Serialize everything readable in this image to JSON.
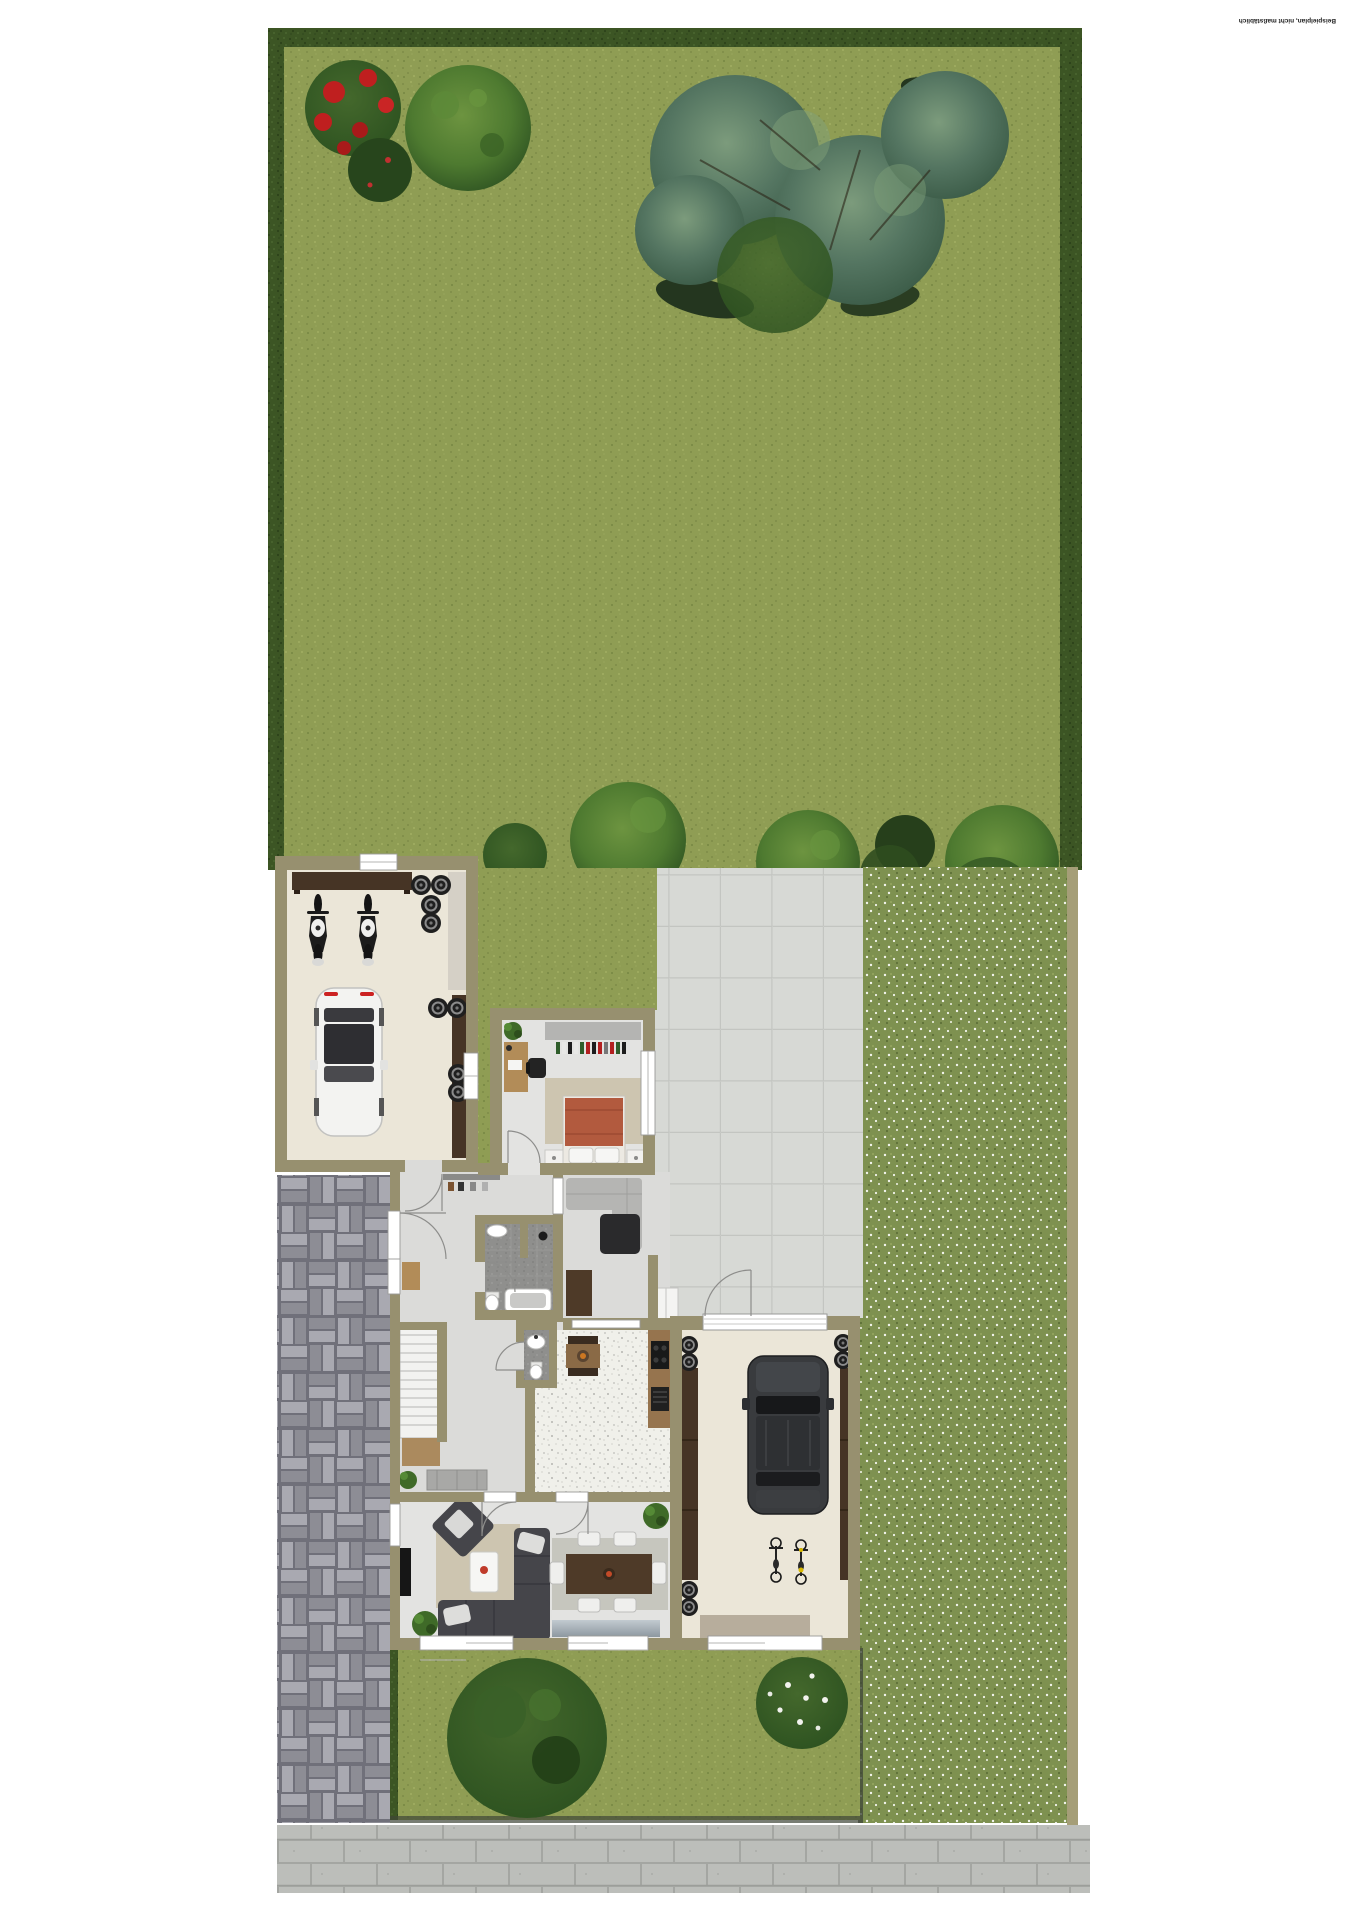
{
  "watermark": {
    "text": "Beispielplan, nicht maßstäblich"
  },
  "palette": {
    "lawn": "#8f9d54",
    "lawn_dot_dark": "#7d8c48",
    "lawn_dot_light": "#a2af62",
    "hedge": "#3c5524",
    "hedge_dot": "#2c421a",
    "meadow": "#7e9150",
    "meadow_dot_white": "#f2f4ec",
    "meadow_dot_dark": "#5e7038",
    "fence": "#a59e78",
    "patio": "#d7d9d5",
    "patio_line": "#c3c5c1",
    "wall": "#97906f",
    "garage_floor": "#ebe6d8",
    "room_floor": "#e3e3e1",
    "hall_floor": "#dbdbd9",
    "kitchen_floor": "#f0f0ea",
    "bath_tile": "#8f8f8d",
    "drive_brick_light": "#a9a9b1",
    "drive_brick_dark": "#8d8d95",
    "drive_gap": "#70707a",
    "sidewalk": "#bcbeba",
    "sidewalk_line": "#9c9e9a",
    "window_white": "#ffffff",
    "wood_light": "#b28c58",
    "wood_dark": "#4e3a28",
    "shelf_brown": "#463425",
    "sofa_dark": "#45454a",
    "sofa_light": "#b5b5b3",
    "bed_terracotta": "#b25a3e",
    "rug_beige": "#cdc5b0",
    "tree_dark": "#2d5220",
    "tree_green": "#4e7a30",
    "tree_teal": "#547561",
    "bush_red": "#bf1f1f",
    "car_white": "#f3f3f1",
    "suv_dark": "#393b3e"
  },
  "plan": {
    "areas": [
      "backyard-lawn",
      "hedge-border",
      "flower-meadow",
      "patio",
      "yard-strip",
      "driveway",
      "front-lawn",
      "sidewalk"
    ],
    "rooms": [
      "motorcycle-garage",
      "bedroom",
      "hallway",
      "bathroom",
      "wc",
      "sitting-area",
      "kitchen",
      "stairs",
      "living-room",
      "car-garage"
    ],
    "vehicles": [
      "white-car",
      "black-suv",
      "motorcycle-1",
      "motorcycle-2",
      "bicycle-1",
      "bicycle-2"
    ],
    "garden_items": [
      "red-flower-bush",
      "green-bush",
      "teal-tree-cluster",
      "row-of-bushes",
      "front-tree",
      "blossom-tree"
    ]
  }
}
